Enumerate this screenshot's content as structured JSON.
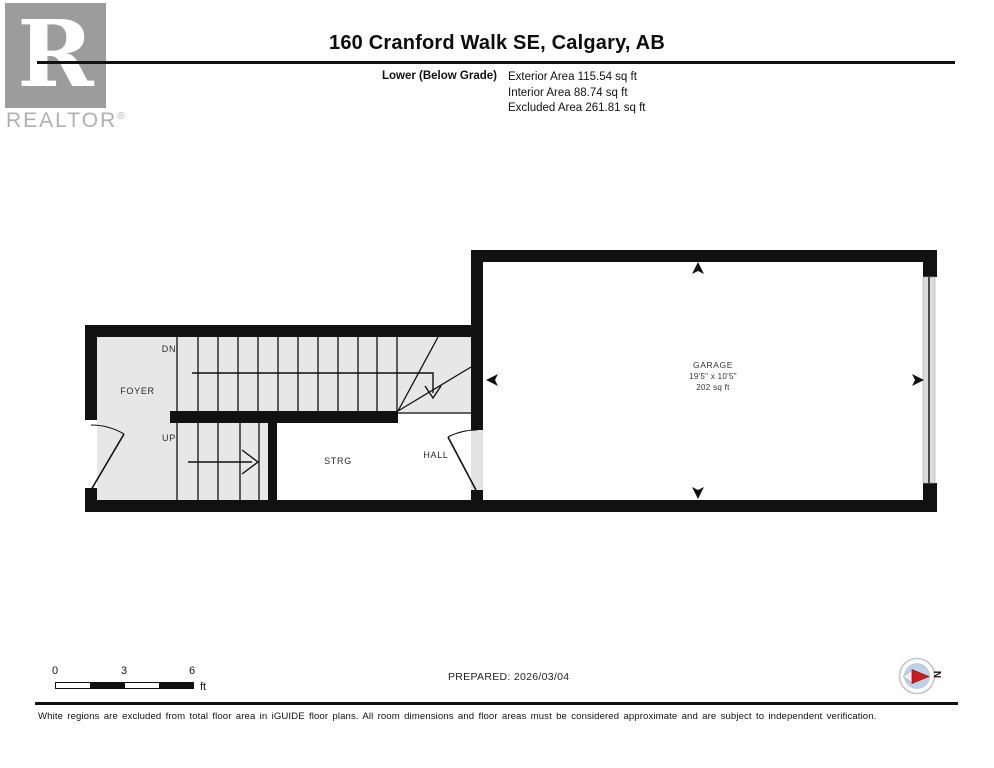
{
  "branding": {
    "logo_letter": "R",
    "logo_text": "REALTOR",
    "logo_registered": "®"
  },
  "header": {
    "title": "160 Cranford Walk SE, Calgary, AB",
    "level_name": "Lower (Below Grade)",
    "areas": {
      "exterior": "Exterior Area 115.54 sq ft",
      "interior": "Interior Area 88.74 sq ft",
      "excluded": "Excluded Area 261.81 sq ft"
    }
  },
  "plan": {
    "labels": {
      "foyer": "FOYER",
      "down": "DN",
      "up": "UP",
      "storage": "STRG",
      "hall": "HALL",
      "garage": "GARAGE",
      "garage_dims": "19'5\" x 10'5\"",
      "garage_area": "202 sq ft"
    },
    "colors": {
      "wall": "#111111",
      "included_floor": "#e7e7e7",
      "excluded_floor": "#ffffff",
      "garage_door": "#dcdcdc"
    }
  },
  "footer": {
    "scale": {
      "ticks": [
        "0",
        "3",
        "6"
      ],
      "unit": "ft"
    },
    "prepared": "PREPARED: 2026/03/04",
    "compass_label": "N",
    "compass_colors": {
      "disc": "#b9d4e8",
      "needle": "#d01818",
      "tail": "#eef2f5"
    }
  },
  "disclaimer": "White regions are excluded from total floor area in iGUIDE floor plans. All room dimensions and floor areas must be considered approximate and are subject to independent verification."
}
